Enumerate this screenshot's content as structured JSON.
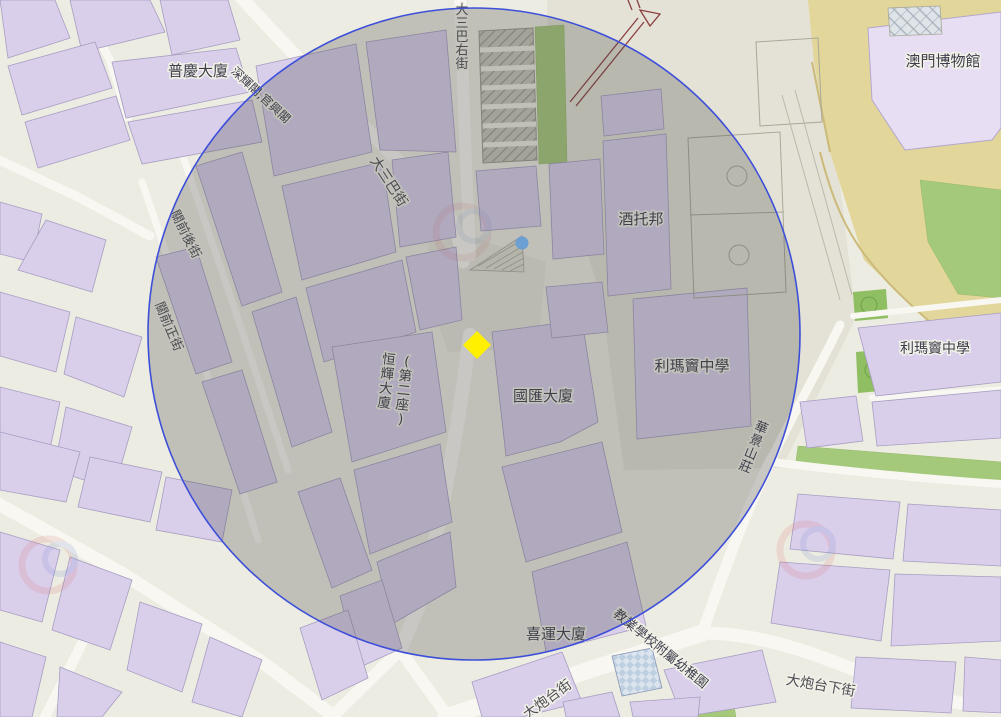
{
  "map": {
    "title": "Macau historic centre map with radius overlay",
    "labels": {
      "building_puqing": "普慶大廈",
      "building_shenhui": "深輝閣,官興閣",
      "street_dasanba_right": "大三巴右街",
      "street_dasanba": "大三巴街",
      "building_jiutuobang": "酒托邦",
      "school_limadou_1": "利瑪竇中學",
      "school_limadou_2": "利瑪竇中學",
      "building_guohui": "國匯大廈",
      "building_henghui_col1": "恒輝大廈",
      "building_henghui_col2": "(第二座)",
      "street_guanqian_back": "關前後街",
      "street_guanqian_main": "關前正街",
      "building_huajing": "華景山莊",
      "museum_macau": "澳門博物館",
      "building_xiyun": "喜運大廈",
      "street_dapaotai": "大炮台街",
      "school_kaoyip_kindergarten": "教業學校附屬幼稚園",
      "street_dapaotai_lower": "大炮台下街"
    },
    "overlay": {
      "type": "radius-circle",
      "stroke_color": "#3D4FD9",
      "fill_color": "rgba(70,70,70,0.27)"
    },
    "marker": {
      "shape": "diamond",
      "color": "#FFF000"
    },
    "poi_dot": {
      "color": "#6C9FD4"
    },
    "palette": {
      "ground": "#EDECE2",
      "building": "#D9CFEB",
      "campus_ground": "#E4E2D6",
      "fort_ground": "#E3D69A",
      "green": "#A5C97A",
      "road": "#F8F7F1",
      "landmark_outline": "#8A4040"
    }
  }
}
